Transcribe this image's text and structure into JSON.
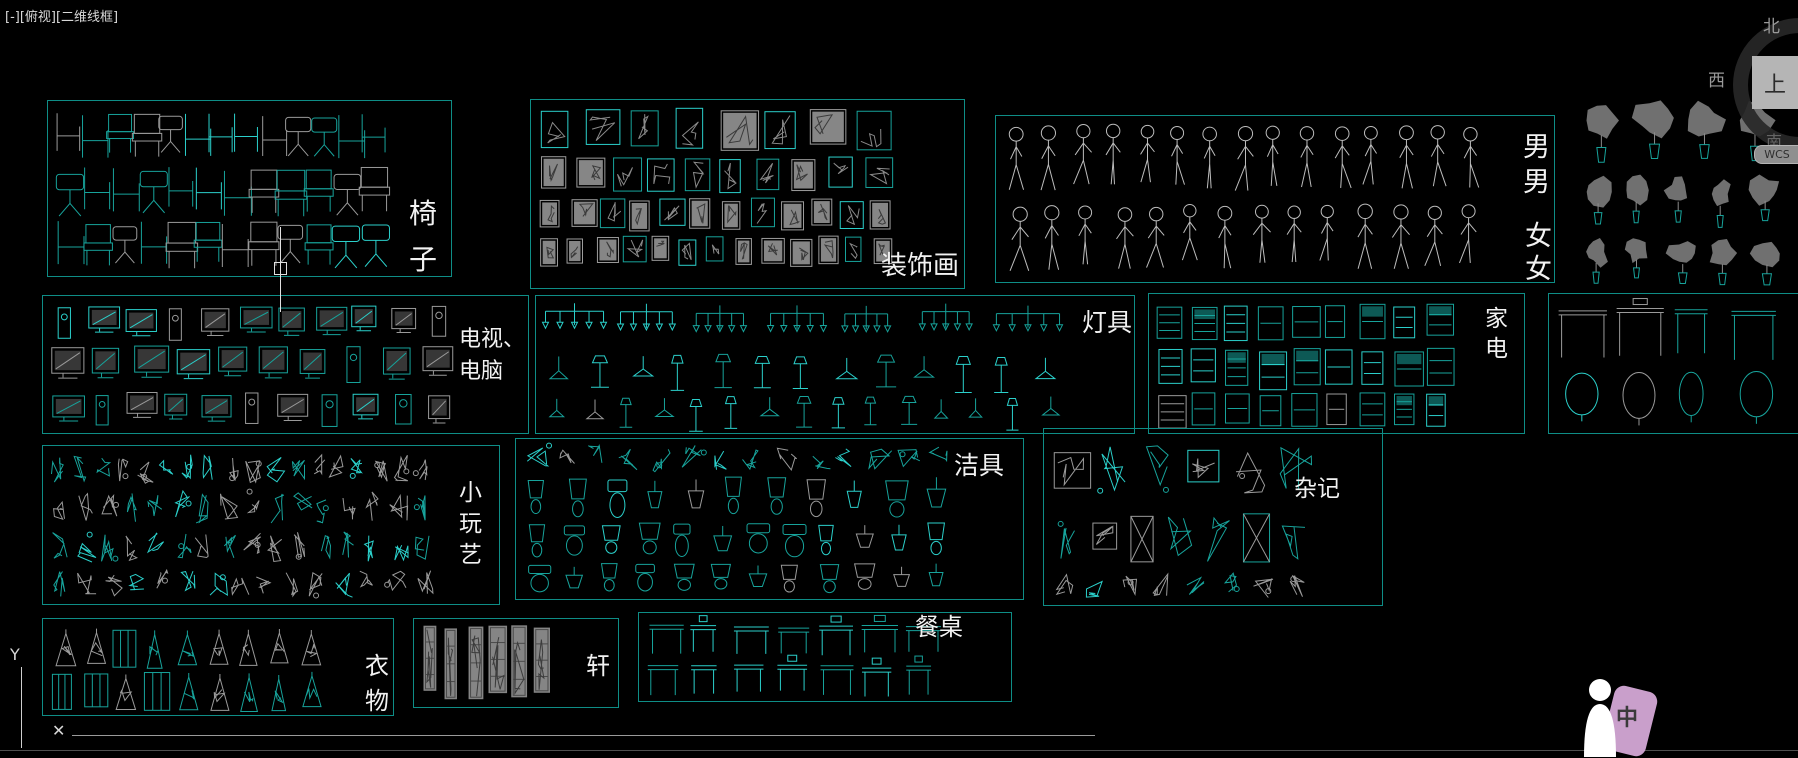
{
  "viewport_label": "[-][俯视][二维线框]",
  "viewcube": {
    "north": "北",
    "west": "西",
    "south": "南",
    "top": "上",
    "wcs": "WCS"
  },
  "ucs": {
    "y_label": "Y"
  },
  "command_bar": {
    "close_label": "✕"
  },
  "person_badge": {
    "label": "中"
  },
  "colors": {
    "background": "#000000",
    "panel_border": "#0e8d86",
    "block_teal": "#17a39b",
    "block_cyan": "#2bd0cb",
    "block_gray": "#9a9a9a",
    "label_text": "#f2f2f2",
    "badge_pink": "#c99fcb"
  },
  "panels": [
    {
      "id": "chairs",
      "kind": "chairs",
      "x": 47,
      "y": 100,
      "w": 403,
      "h": 175,
      "labels": [
        {
          "lines": [
            "椅",
            "子"
          ],
          "x": 361,
          "y": 90,
          "size": 28,
          "lh": 46
        }
      ]
    },
    {
      "id": "paintings",
      "kind": "frames",
      "x": 530,
      "y": 99,
      "w": 433,
      "h": 188,
      "labels": [
        {
          "lines": [
            "装饰画"
          ],
          "x": 350,
          "y": 152,
          "size": 26,
          "lh": 28
        }
      ]
    },
    {
      "id": "people",
      "kind": "people",
      "x": 995,
      "y": 115,
      "w": 558,
      "h": 166,
      "labels": [
        {
          "lines": [
            "男",
            "男"
          ],
          "x": 527,
          "y": 14,
          "size": 27,
          "lh": 35
        },
        {
          "lines": [
            "女",
            "女"
          ],
          "x": 529,
          "y": 104,
          "size": 27,
          "lh": 33
        }
      ]
    },
    {
      "id": "plants",
      "kind": "plants",
      "x": 1575,
      "y": 88,
      "w": 223,
      "h": 202,
      "noborder": true,
      "labels": []
    },
    {
      "id": "tv",
      "kind": "tv",
      "x": 42,
      "y": 295,
      "w": 485,
      "h": 137,
      "labels": [
        {
          "lines": [
            "电视、",
            "电脑"
          ],
          "x": 416,
          "y": 28,
          "size": 22,
          "lh": 32
        }
      ]
    },
    {
      "id": "lamps",
      "kind": "lamps",
      "x": 535,
      "y": 295,
      "w": 598,
      "h": 137,
      "labels": [
        {
          "lines": [
            "灯具"
          ],
          "x": 546,
          "y": 14,
          "size": 25,
          "lh": 26
        }
      ]
    },
    {
      "id": "appliances",
      "kind": "appliances",
      "x": 1148,
      "y": 293,
      "w": 375,
      "h": 139,
      "labels": [
        {
          "lines": [
            "家",
            "电"
          ],
          "x": 336,
          "y": 10,
          "size": 23,
          "lh": 30
        }
      ]
    },
    {
      "id": "consoles",
      "kind": "consoles",
      "x": 1548,
      "y": 293,
      "w": 250,
      "h": 139,
      "noright": true,
      "labels": []
    },
    {
      "id": "toys",
      "kind": "toys",
      "x": 42,
      "y": 445,
      "w": 456,
      "h": 158,
      "labels": [
        {
          "lines": [
            "小",
            "玩",
            "艺"
          ],
          "x": 416,
          "y": 32,
          "size": 23,
          "lh": 31
        }
      ]
    },
    {
      "id": "sanitary",
      "kind": "sanitary",
      "x": 515,
      "y": 438,
      "w": 507,
      "h": 160,
      "labels": [
        {
          "lines": [
            "洁具"
          ],
          "x": 438,
          "y": 14,
          "size": 25,
          "lh": 26
        }
      ]
    },
    {
      "id": "misc",
      "kind": "misc",
      "x": 1043,
      "y": 428,
      "w": 338,
      "h": 176,
      "labels": [
        {
          "lines": [
            "杂记"
          ],
          "x": 250,
          "y": 48,
          "size": 23,
          "lh": 24
        }
      ]
    },
    {
      "id": "clothes",
      "kind": "clothes",
      "x": 42,
      "y": 618,
      "w": 350,
      "h": 96,
      "labels": [
        {
          "lines": [
            "衣",
            "物"
          ],
          "x": 322,
          "y": 30,
          "size": 24,
          "lh": 35
        }
      ]
    },
    {
      "id": "xuan",
      "kind": "xuan",
      "x": 413,
      "y": 618,
      "w": 204,
      "h": 88,
      "labels": [
        {
          "lines": [
            "轩"
          ],
          "x": 172,
          "y": 34,
          "size": 24,
          "lh": 26
        }
      ]
    },
    {
      "id": "dining",
      "kind": "dining",
      "x": 638,
      "y": 612,
      "w": 372,
      "h": 88,
      "labels": [
        {
          "lines": [
            "餐桌"
          ],
          "x": 276,
          "y": 2,
          "size": 24,
          "lh": 25
        }
      ]
    }
  ]
}
